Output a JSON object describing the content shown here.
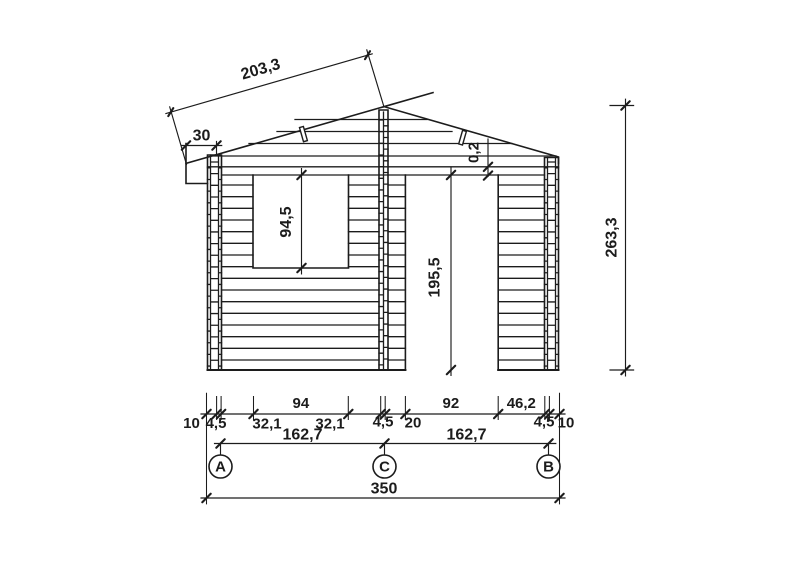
{
  "drawing": {
    "kind": "front-elevation",
    "subject": "log cabin / garden shed elevation with dimension chains"
  },
  "dimensions": {
    "roof_slope_length": "203,3",
    "roof_overhang": "30",
    "door_top_gap": "0,2",
    "window_height": "94,5",
    "door_height": "195,5",
    "overall_height": "263,3",
    "bottom_chain": [
      "10",
      "4,5",
      "32,1",
      "94",
      "32,1",
      "4,5",
      "20",
      "92",
      "46,2",
      "4,5",
      "10"
    ],
    "axis_spacings": [
      "162,7",
      "162,7"
    ],
    "overall_width": "350"
  },
  "axes": {
    "labels": [
      "A",
      "C",
      "B"
    ]
  },
  "colors": {
    "line": "#1c1c1c",
    "background": "#ffffff"
  }
}
